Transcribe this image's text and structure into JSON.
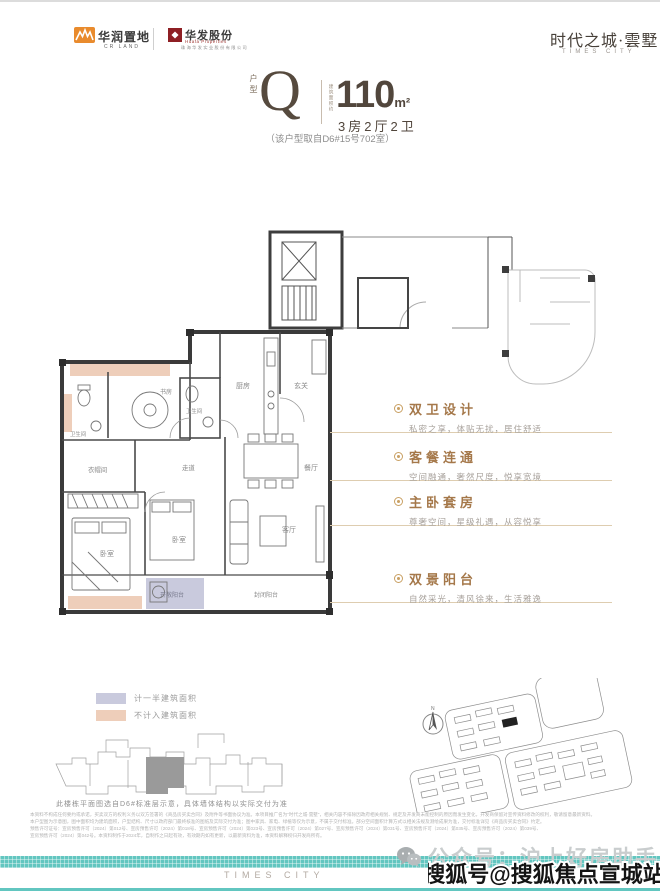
{
  "header": {
    "crland": {
      "name": "华润置地",
      "sub": "CR LAND"
    },
    "huafa": {
      "name": "华发股份",
      "sub": "Huafa Properties",
      "tagline": "珠海华发实业股份有限公司"
    },
    "brand": {
      "name": "时代之城·雲墅",
      "sub": "TIMES CITY"
    }
  },
  "unit": {
    "label": "户型",
    "letter": "Q",
    "area_prefix": "建筑面积约",
    "area": "110",
    "area_unit": "m²",
    "rooms": "3房2厅2卫",
    "source": "（该户型取自D6#15号702室）"
  },
  "floorplan": {
    "rooms": [
      "厨房",
      "玄关",
      "卫生间",
      "书房",
      "卫生间",
      "衣帽间",
      "走道",
      "餐厅",
      "客厅",
      "卧室",
      "卧室",
      "开敞阳台",
      "封闭阳台"
    ],
    "compass": "N"
  },
  "features": [
    {
      "title": "双卫设计",
      "desc": "私密之享，体贴无扰，居住舒适"
    },
    {
      "title": "客餐连通",
      "desc": "空间融通，奢然尺度，悦享宽境"
    },
    {
      "title": "主卧套房",
      "desc": "尊奢空间，星级礼遇，从容悦享"
    },
    {
      "title": "双景阳台",
      "desc": "自然采光，清风徐来，生活雅逸"
    }
  ],
  "legend": [
    {
      "label": "计一半建筑面积",
      "color": "#c9cadd"
    },
    {
      "label": "不计入建筑面积",
      "color": "#eeceba"
    }
  ],
  "plate": {
    "note": "此楼栋平面图选自D6#标准层示意，具体墙体结构以实际交付为准"
  },
  "disclaimer": [
    "本资料不构成任何要约或承诺，买卖双方的权利义务以双方签署的《商品房买卖合同》及附件等书面协议为准。本项目推广名为“时代之城·雲墅”，相关内容不排除因政府相关规划、规定及开发商未能控制的原因而发生变化，开发商保留对宣传资料修改的权利，敬请留意最新资料。",
    "本户型图为示意图，图中面积均为建筑面积，户型结构、尺寸以政府部门最终核准的图纸及实际交付为准；图中家具、家电、绿植等仅为示意，不属于交付标准。部分空间面积计算方式以相关法规及测绘成果为准，交付标准详见《商品房买卖合同》约定。",
    "预售许可证号：宣房预售许可（2024）第012号、宣房预售许可（2024）第018号、宣房预售许可（2024）第023号、宣房预售许可（2024）第027号、宣房预售许可（2024）第031号、宣房预售许可（2024）第035号、宣房预售许可（2024）第039号、",
    "宣房预售许可（2024）第042号。本资料制作于2024年，自制作之日起有效，有效期内如有更新，以最新资料为准，本资料解释权归开发商所有。"
  ],
  "footer": {
    "brand": "TIMES CITY",
    "wechat": "公众号：沪上好房助手",
    "watermark": "搜狐号@搜狐焦点宣城站"
  },
  "colors": {
    "teal": "#62c6c0",
    "pink": "#eeceba",
    "lavender": "#c9cadd",
    "feature_brown": "#a5784a",
    "crland_orange": "#e98b2d",
    "huafa_red": "#8e1f24"
  }
}
